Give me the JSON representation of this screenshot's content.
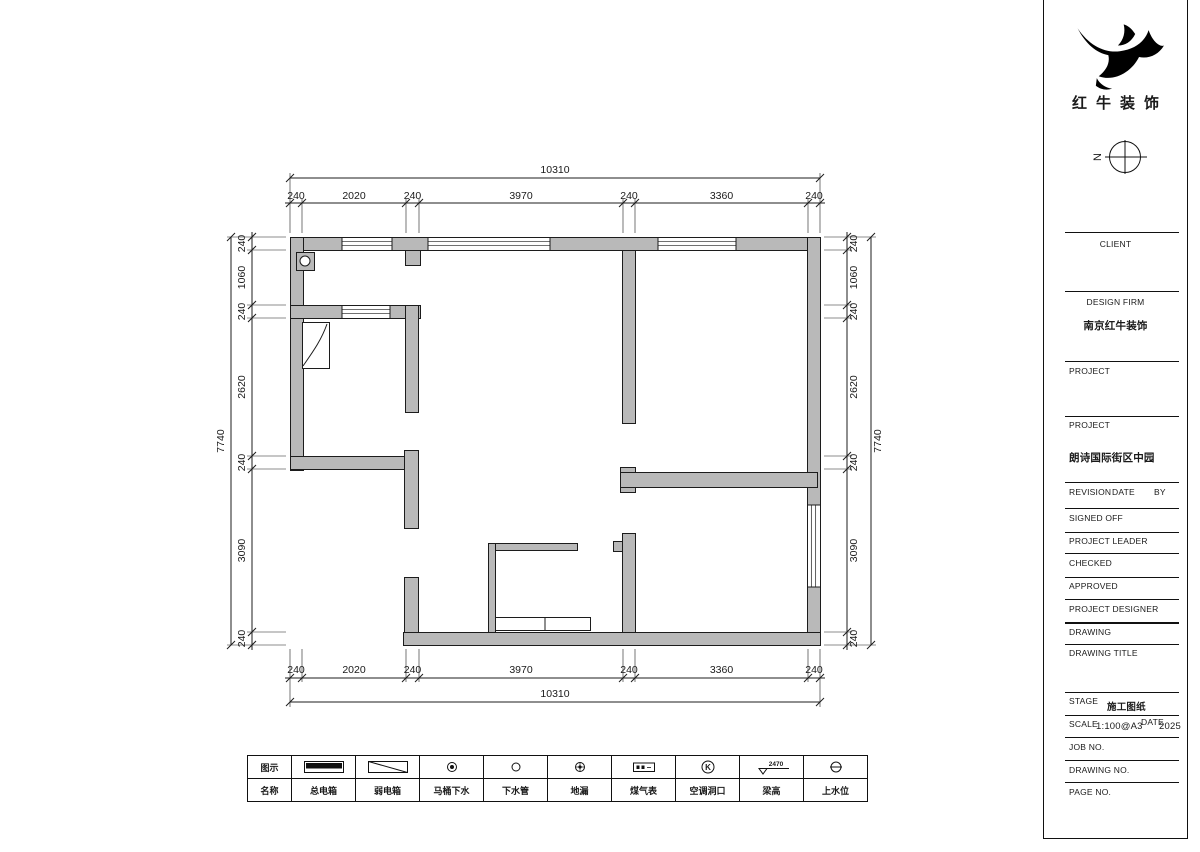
{
  "colors": {
    "bg": "#ffffff",
    "wall_fill": "#b9b9b9",
    "line": "#1c1c1c"
  },
  "brand": {
    "name": "红牛装饰",
    "compass_label": "N"
  },
  "plan": {
    "dim_top": {
      "total": "10310",
      "segments": [
        "240",
        "2020",
        "240",
        "3970",
        "240",
        "3360",
        "240"
      ]
    },
    "dim_bottom": {
      "total": "10310",
      "segments": [
        "240",
        "2020",
        "240",
        "3970",
        "240",
        "3360",
        "240"
      ]
    },
    "dim_left": {
      "total": "7740",
      "segments": [
        "240",
        "1060",
        "240",
        "2620",
        "240",
        "3090",
        "240"
      ]
    },
    "dim_right": {
      "total": "7740",
      "segments": [
        "240",
        "1060",
        "240",
        "2620",
        "240",
        "3090",
        "240"
      ]
    },
    "geometry": {
      "x_ticks": [
        290,
        302,
        406,
        419,
        623,
        635,
        808,
        820
      ],
      "y_ticks": [
        237,
        250,
        305,
        318,
        456,
        469,
        632,
        645
      ],
      "walls": [
        [
          290,
          237,
          530,
          13
        ],
        [
          290,
          237,
          13,
          233
        ],
        [
          807,
          237,
          13,
          408
        ],
        [
          403,
          632,
          417,
          13
        ],
        [
          290,
          305,
          130,
          13
        ],
        [
          405,
          305,
          13,
          107
        ],
        [
          290,
          456,
          128,
          13
        ],
        [
          404,
          450,
          14,
          78
        ],
        [
          404,
          577,
          14,
          55
        ],
        [
          622,
          250,
          13,
          173
        ],
        [
          620,
          467,
          15,
          25
        ],
        [
          620,
          472,
          197,
          15
        ],
        [
          622,
          533,
          13,
          99
        ],
        [
          613,
          541,
          9,
          10
        ],
        [
          405,
          250,
          15,
          15
        ]
      ],
      "thin_walls": [
        [
          488,
          543,
          89,
          7
        ],
        [
          488,
          543,
          7,
          89
        ]
      ],
      "windows_h": [
        [
          342,
          237,
          50,
          13
        ],
        [
          428,
          237,
          122,
          13
        ],
        [
          658,
          237,
          78,
          13
        ],
        [
          342,
          305,
          48,
          13
        ]
      ],
      "windows_v": [
        [
          807,
          505,
          13,
          82
        ]
      ],
      "flue": [
        296,
        252,
        18,
        18
      ],
      "door_rect": [
        302,
        322,
        27,
        46
      ],
      "door_arc": "M327,324 C321,341 312,353 303,366",
      "counter": {
        "rect": [
          495,
          617,
          95,
          13
        ],
        "divider_x": 545
      }
    }
  },
  "legend": {
    "header_symbol": "图示",
    "header_name": "名称",
    "items": [
      {
        "name": "总电箱",
        "symbol": "main-power-box"
      },
      {
        "name": "弱电箱",
        "symbol": "low-voltage-box"
      },
      {
        "name": "马桶下水",
        "symbol": "toilet-drain"
      },
      {
        "name": "下水管",
        "symbol": "drain-pipe"
      },
      {
        "name": "地漏",
        "symbol": "floor-drain"
      },
      {
        "name": "煤气表",
        "symbol": "gas-meter"
      },
      {
        "name": "空调洞口",
        "symbol": "ac-opening",
        "glyph": "K"
      },
      {
        "name": "梁高",
        "symbol": "beam-height",
        "value": "2470"
      },
      {
        "name": "上水位",
        "symbol": "water-supply-level"
      }
    ]
  },
  "titleblock": {
    "client_label": "CLIENT",
    "design_firm_label": "DESIGN FIRM",
    "design_firm_value": "南京红牛装饰",
    "project1_label": "PROJECT",
    "project2_label": "PROJECT",
    "project_value": "朗诗国际街区中园",
    "revision_label": "REVISION",
    "date_label": "DATE",
    "by_label": "BY",
    "signed_off_label": "SIGNED OFF",
    "project_leader_label": "PROJECT LEADER",
    "checked_label": "CHECKED",
    "approved_label": "APPROVED",
    "project_designer_label": "PROJECT DESIGNER",
    "drawing_label": "DRAWING",
    "drawing_title_label": "DRAWING TITLE",
    "stage_label": "STAGE",
    "stage_value": "施工图纸",
    "scale_label": "SCALE",
    "scale_value": "1:100@A3",
    "date2_label": "DATE",
    "date_value": "2025",
    "job_no_label": "JOB NO.",
    "drawing_no_label": "DRAWING NO.",
    "page_no_label": "PAGE NO."
  }
}
